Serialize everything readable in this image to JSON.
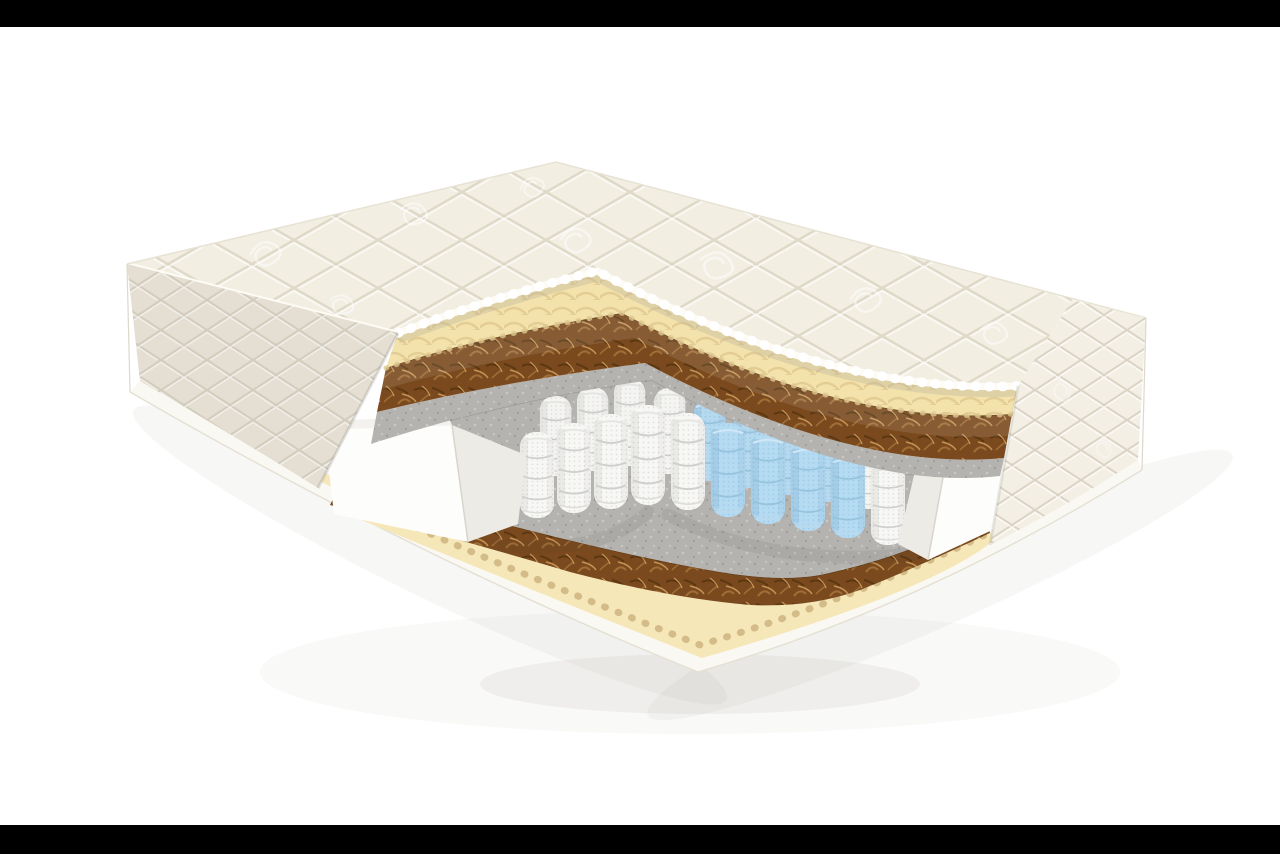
{
  "scene": {
    "kind": "product-render",
    "subject": "mattress-cutaway-cross-section",
    "background": "#ffffff",
    "letterbox": "#000000",
    "shadow": "#8d897e"
  },
  "materials": {
    "quilted_cover": {
      "name": "quilted-top-cover",
      "color": "#f2eee2",
      "seam": "#d8d1bf",
      "print": "#ffffff"
    },
    "side_panel_left": {
      "name": "quilted-side-panel-left",
      "color": "#ebe6d8",
      "seam": "#d6cfbf"
    },
    "side_panel_right": {
      "name": "quilted-side-panel-right",
      "color": "#f3efe4",
      "seam": "#ddd6c6"
    },
    "piping": {
      "name": "piping-edge",
      "color": "#fdfbf4",
      "shadow": "#b9b19d"
    },
    "egg_crate_foam": {
      "name": "egg-crate-foam-layer",
      "color": "#f3e2ab",
      "wave": "#dfc890",
      "light": "#f8edc8"
    },
    "coconut_coir": {
      "name": "coconut-coir-layer",
      "color": "#7a4a1e",
      "fiber_light": "#a06f36",
      "fiber_pale": "#c29255",
      "fiber_dark": "#5b3712"
    },
    "felt": {
      "name": "felt-layer",
      "color": "#b5b3b0",
      "speck_dark": "#a09e9a",
      "speck_light": "#cac8c4"
    },
    "pocket_spring": {
      "name": "pocket-spring-white",
      "color": "#f7f7f5",
      "seam": "#cfcfcd",
      "mesh": "#e0dfdc"
    },
    "comfort_spring": {
      "name": "pocket-spring-blue-comfort-zone",
      "color": "#b5dbf2",
      "seam": "#96c3de",
      "mesh": "#9ccae6"
    },
    "foam_border": {
      "name": "foam-border-box",
      "color": "#fdfdfb",
      "cut_face": "#edebe5"
    },
    "bottom_foam": {
      "name": "bottom-foam-layer",
      "color": "#f6e7b9",
      "scallop": "#cdb47e"
    },
    "base": {
      "name": "bottom-base-cover",
      "color": "#faf8f2",
      "edge": "#e4e0d3"
    }
  },
  "springs": {
    "blue_zone_columns": 4,
    "front_row_visible": 10,
    "back_row_visible": 9
  }
}
